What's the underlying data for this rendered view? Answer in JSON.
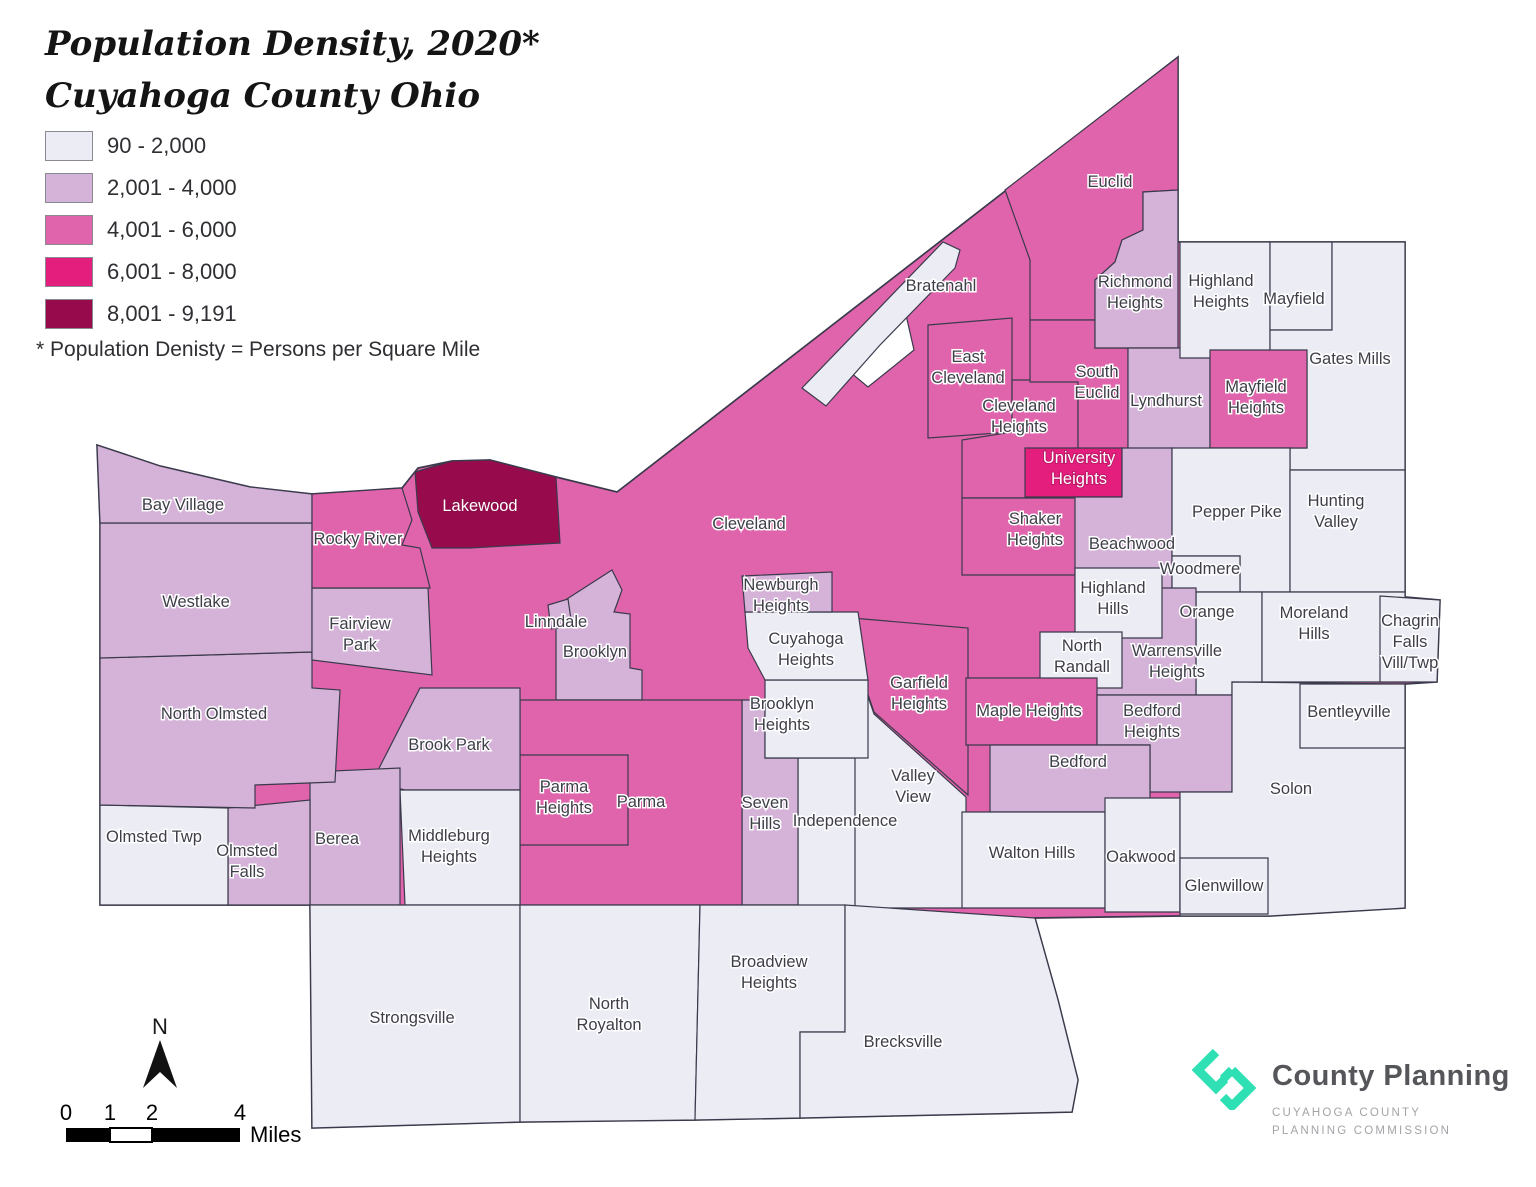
{
  "title": {
    "line1": "Population Density, 2020*",
    "line2": "Cuyahoga County Ohio"
  },
  "footnote": "* Population Denisty = Persons per Square Mile",
  "legend": {
    "items": [
      {
        "label": "90 - 2,000",
        "color": "#ececf4"
      },
      {
        "label": "2,001 - 4,000",
        "color": "#d5b2d8"
      },
      {
        "label": "4,001 - 6,000",
        "color": "#df64ab"
      },
      {
        "label": "6,001 - 8,000",
        "color": "#e41e7d"
      },
      {
        "label": "8,001 - 9,191",
        "color": "#970b4c"
      }
    ],
    "stroke": "#3a3a4c",
    "water": "#ffffff"
  },
  "scale_bar": {
    "ticks": [
      "0",
      "1",
      "2",
      "4"
    ],
    "tick_x": [
      66,
      110,
      152,
      240
    ],
    "unit": "Miles"
  },
  "north_arrow": {
    "label": "N"
  },
  "logo": {
    "name": "County Planning",
    "sub1": "CUYAHOGA COUNTY",
    "sub2": "PLANNING COMMISSION",
    "accent": "#2ee0b4"
  },
  "map": {
    "regions": [
      {
        "name": "Cleveland",
        "class": 3,
        "points": "97,445 160,466 250,487 312,494 402,488 418,468 452,461 490,460 556,477 617,492 1178,57 1178,242 1405,242 1405,597 1440,600 1437,682 1405,684 1405,908 1270,916 1180,916 1035,918 1058,1000 1078,1080 1072,1112 800,1118 695,1120 520,1122 312,1128 310,905 255,905 100,905 100,660 100,523",
        "label": {
          "x": 749,
          "y": 529,
          "lines": [
            "Cleveland"
          ]
        }
      },
      {
        "name": "Euclid",
        "class": 3,
        "points": "1005,190 1178,57 1178,190 1143,192 1143,230 1122,240 1115,262 1095,280 1095,320 1030,320 1030,260",
        "label": {
          "x": 1110,
          "y": 187,
          "lines": [
            "Euclid"
          ]
        }
      },
      {
        "name": "Lake Erie inlet",
        "class": 0,
        "points": "850,372 906,315 914,350 868,387",
        "label": null
      },
      {
        "name": "Bratenahl",
        "class": 1,
        "points": "802,388 943,242 960,250 955,268 880,345 826,406",
        "label": {
          "x": 941,
          "y": 291,
          "lines": [
            "Bratenahl"
          ]
        }
      },
      {
        "name": "East Cleveland",
        "class": 3,
        "points": "928,325 1012,318 1012,432 928,438",
        "label": {
          "x": 968,
          "y": 362,
          "lines": [
            "East",
            "Cleveland"
          ]
        }
      },
      {
        "name": "Cleveland Heights",
        "class": 3,
        "points": "1012,380 1078,380 1078,498 962,498 962,440 1012,432",
        "label": {
          "x": 1019,
          "y": 411,
          "lines": [
            "Cleveland",
            "Heights"
          ]
        }
      },
      {
        "name": "South Euclid",
        "class": 3,
        "points": "1030,320 1095,320 1095,348 1128,348 1128,450 1078,450 1078,382 1030,382",
        "label": {
          "x": 1097,
          "y": 377,
          "lines": [
            "South",
            "Euclid"
          ]
        }
      },
      {
        "name": "Richmond Heights",
        "class": 2,
        "points": "1143,192 1178,190 1178,348 1095,348 1095,280 1115,262 1122,240 1143,230",
        "label": {
          "x": 1135,
          "y": 287,
          "lines": [
            "Richmond",
            "Heights"
          ]
        }
      },
      {
        "name": "Lyndhurst",
        "class": 2,
        "points": "1128,348 1210,348 1210,450 1128,450",
        "label": {
          "x": 1166,
          "y": 406,
          "lines": [
            "Lyndhurst"
          ]
        }
      },
      {
        "name": "Highland Heights",
        "class": 1,
        "points": "1180,242 1270,242 1270,358 1180,358",
        "label": {
          "x": 1221,
          "y": 286,
          "lines": [
            "Highland",
            "Heights"
          ]
        }
      },
      {
        "name": "Mayfield",
        "class": 1,
        "points": "1270,242 1332,242 1332,330 1270,330",
        "label": {
          "x": 1294,
          "y": 304,
          "lines": [
            "Mayfield"
          ]
        }
      },
      {
        "name": "Gates Mills",
        "class": 1,
        "points": "1332,242 1405,242 1405,470 1290,470 1290,448 1307,448 1307,358 1270,358 1270,330 1332,330",
        "label": {
          "x": 1350,
          "y": 364,
          "lines": [
            "Gates Mills"
          ]
        }
      },
      {
        "name": "Mayfield Heights",
        "class": 3,
        "points": "1210,350 1307,350 1307,448 1210,448",
        "label": {
          "x": 1256,
          "y": 392,
          "lines": [
            "Mayfield",
            "Heights"
          ]
        }
      },
      {
        "name": "University Heights",
        "class": 4,
        "points": "1025,448 1122,448 1122,497 1025,497",
        "label": {
          "x": 1079,
          "y": 463,
          "lines": [
            "University",
            "Heights"
          ],
          "white": true
        }
      },
      {
        "name": "Shaker Heights",
        "class": 3,
        "points": "962,498 1120,498 1120,575 962,575",
        "label": {
          "x": 1035,
          "y": 524,
          "lines": [
            "Shaker",
            "Heights"
          ]
        }
      },
      {
        "name": "Beachwood",
        "class": 2,
        "points": "1075,497 1122,497 1122,448 1172,448 1172,592 1075,592",
        "label": {
          "x": 1132,
          "y": 549,
          "lines": [
            "Beachwood"
          ]
        }
      },
      {
        "name": "Pepper Pike",
        "class": 1,
        "points": "1172,448 1290,448 1290,592 1240,592 1240,556 1172,556",
        "label": {
          "x": 1237,
          "y": 517,
          "lines": [
            "Pepper Pike"
          ]
        }
      },
      {
        "name": "Woodmere",
        "class": 1,
        "points": "1172,556 1240,556 1240,592 1172,592",
        "label": {
          "x": 1200,
          "y": 574,
          "lines": [
            "Woodmere"
          ]
        }
      },
      {
        "name": "Hunting Valley",
        "class": 1,
        "points": "1290,470 1405,470 1405,592 1290,592",
        "label": {
          "x": 1336,
          "y": 506,
          "lines": [
            "Hunting",
            "Valley"
          ]
        }
      },
      {
        "name": "Orange",
        "class": 1,
        "points": "1196,592 1262,592 1262,682 1232,682 1232,695 1196,695",
        "label": {
          "x": 1207,
          "y": 617,
          "lines": [
            "Orange"
          ]
        }
      },
      {
        "name": "Moreland Hills",
        "class": 1,
        "points": "1262,592 1405,592 1405,682 1262,682",
        "label": {
          "x": 1314,
          "y": 618,
          "lines": [
            "Moreland",
            "Hills"
          ]
        }
      },
      {
        "name": "Chagrin Falls Vill/Twp",
        "class": 1,
        "points": "1380,596 1440,600 1437,682 1380,682",
        "label": {
          "x": 1410,
          "y": 626,
          "lines": [
            "Chagrin",
            "Falls",
            "Vill/Twp"
          ]
        }
      },
      {
        "name": "Warrensville Heights",
        "class": 2,
        "points": "1095,588 1196,588 1196,695 1095,695",
        "label": {
          "x": 1177,
          "y": 656,
          "lines": [
            "Warrensville",
            "Heights"
          ]
        }
      },
      {
        "name": "Highland Hills",
        "class": 1,
        "points": "1075,568 1162,568 1162,638 1075,638",
        "label": {
          "x": 1113,
          "y": 593,
          "lines": [
            "Highland",
            "Hills"
          ]
        }
      },
      {
        "name": "North Randall",
        "class": 1,
        "points": "1040,632 1122,632 1122,688 1040,688",
        "label": {
          "x": 1082,
          "y": 651,
          "lines": [
            "North",
            "Randall"
          ]
        }
      },
      {
        "name": "Garfield Heights",
        "class": 3,
        "points": "852,618 968,628 968,795 874,712 852,648",
        "label": {
          "x": 919,
          "y": 688,
          "lines": [
            "Garfield",
            "Heights"
          ]
        }
      },
      {
        "name": "Valley View",
        "class": 1,
        "points": "852,650 874,714 966,797 966,908 852,908",
        "label": {
          "x": 913,
          "y": 781,
          "lines": [
            "Valley",
            "View"
          ]
        }
      },
      {
        "name": "Maple Heights",
        "class": 3,
        "points": "966,678 1097,678 1097,745 966,745",
        "label": {
          "x": 1029,
          "y": 716,
          "lines": [
            "Maple Heights"
          ]
        }
      },
      {
        "name": "Bedford Heights",
        "class": 2,
        "points": "1097,695 1232,695 1232,792 1150,792 1150,745 1097,745",
        "label": {
          "x": 1152,
          "y": 716,
          "lines": [
            "Bedford",
            "Heights"
          ]
        }
      },
      {
        "name": "Bedford",
        "class": 2,
        "points": "990,745 1150,745 1150,812 990,812",
        "label": {
          "x": 1078,
          "y": 767,
          "lines": [
            "Bedford"
          ]
        }
      },
      {
        "name": "Walton Hills",
        "class": 1,
        "points": "962,812 1105,812 1105,908 962,908",
        "label": {
          "x": 1032,
          "y": 858,
          "lines": [
            "Walton Hills"
          ]
        }
      },
      {
        "name": "Oakwood",
        "class": 1,
        "points": "1105,798 1180,798 1180,912 1105,912",
        "label": {
          "x": 1141,
          "y": 862,
          "lines": [
            "Oakwood"
          ]
        }
      },
      {
        "name": "Solon",
        "class": 1,
        "points": "1232,682 1405,684 1405,908 1270,916 1180,916 1180,792 1232,792",
        "label": {
          "x": 1291,
          "y": 794,
          "lines": [
            "Solon"
          ]
        }
      },
      {
        "name": "Bentleyville",
        "class": 1,
        "points": "1300,684 1405,684 1405,748 1300,748",
        "label": {
          "x": 1349,
          "y": 717,
          "lines": [
            "Bentleyville"
          ]
        }
      },
      {
        "name": "Glenwillow",
        "class": 1,
        "points": "1180,858 1268,858 1268,914 1180,914",
        "label": {
          "x": 1224,
          "y": 891,
          "lines": [
            "Glenwillow"
          ]
        }
      },
      {
        "name": "Independence",
        "class": 1,
        "points": "798,758 855,758 855,908 798,908",
        "label": {
          "x": 845,
          "y": 826,
          "lines": [
            "Independence"
          ]
        }
      },
      {
        "name": "Seven Hills",
        "class": 2,
        "points": "742,700 765,700 765,758 798,758 798,905 742,905",
        "label": {
          "x": 765,
          "y": 808,
          "lines": [
            "Seven",
            "Hills"
          ]
        }
      },
      {
        "name": "Brooklyn Heights",
        "class": 1,
        "points": "765,680 868,680 868,758 765,758",
        "label": {
          "x": 782,
          "y": 709,
          "lines": [
            "Brooklyn",
            "Heights"
          ]
        }
      },
      {
        "name": "Cuyahoga Heights",
        "class": 1,
        "points": "745,612 858,612 868,680 765,680 748,648",
        "label": {
          "x": 806,
          "y": 644,
          "lines": [
            "Cuyahoga",
            "Heights"
          ]
        }
      },
      {
        "name": "Newburgh Heights",
        "class": 2,
        "points": "742,576 832,572 832,612 745,612",
        "label": {
          "x": 781,
          "y": 590,
          "lines": [
            "Newburgh",
            "Heights"
          ]
        }
      },
      {
        "name": "Brooklyn",
        "class": 2,
        "points": "556,606 612,570 622,590 614,612 630,614 630,668 642,670 642,700 556,700",
        "label": {
          "x": 595,
          "y": 657,
          "lines": [
            "Brooklyn"
          ]
        }
      },
      {
        "name": "Linndale",
        "class": 2,
        "points": "548,605 568,599 572,626 551,629",
        "label": {
          "x": 556,
          "y": 627,
          "lines": [
            "Linndale"
          ]
        }
      },
      {
        "name": "Parma",
        "class": 3,
        "points": "520,700 742,700 742,905 520,905",
        "label": {
          "x": 641,
          "y": 807,
          "lines": [
            "Parma"
          ]
        }
      },
      {
        "name": "Parma Heights",
        "class": 3,
        "points": "520,755 628,755 628,845 520,845",
        "label": {
          "x": 564,
          "y": 792,
          "lines": [
            "Parma",
            "Heights"
          ]
        }
      },
      {
        "name": "Brook Park",
        "class": 2,
        "points": "420,688 520,688 520,790 405,790 372,782",
        "label": {
          "x": 449,
          "y": 750,
          "lines": [
            "Brook Park"
          ]
        }
      },
      {
        "name": "Middleburg Heights",
        "class": 1,
        "points": "400,790 520,790 520,905 405,905",
        "label": {
          "x": 449,
          "y": 841,
          "lines": [
            "Middleburg",
            "Heights"
          ]
        }
      },
      {
        "name": "Berea",
        "class": 2,
        "points": "310,772 400,768 400,905 310,905",
        "label": {
          "x": 337,
          "y": 844,
          "lines": [
            "Berea"
          ]
        }
      },
      {
        "name": "Olmsted Falls",
        "class": 2,
        "points": "228,808 310,800 310,905 228,905",
        "label": {
          "x": 247,
          "y": 856,
          "lines": [
            "Olmsted",
            "Falls"
          ]
        }
      },
      {
        "name": "Olmsted Twp",
        "class": 1,
        "points": "100,805 228,808 228,905 100,905",
        "label": {
          "x": 154,
          "y": 842,
          "lines": [
            "Olmsted Twp"
          ]
        }
      },
      {
        "name": "North Olmsted",
        "class": 2,
        "points": "100,658 312,652 312,688 340,690 335,782 255,785 255,808 100,805",
        "label": {
          "x": 214,
          "y": 719,
          "lines": [
            "North Olmsted"
          ]
        }
      },
      {
        "name": "Westlake",
        "class": 2,
        "points": "100,523 312,523 312,652 100,658",
        "label": {
          "x": 196,
          "y": 607,
          "lines": [
            "Westlake"
          ]
        }
      },
      {
        "name": "Bay Village",
        "class": 2,
        "points": "97,445 160,466 250,487 312,494 312,523 100,523",
        "label": {
          "x": 183,
          "y": 510,
          "lines": [
            "Bay Village"
          ]
        }
      },
      {
        "name": "Fairview Park",
        "class": 2,
        "points": "312,588 428,588 432,675 312,660",
        "label": {
          "x": 360,
          "y": 629,
          "lines": [
            "Fairview",
            "Park"
          ]
        }
      },
      {
        "name": "Rocky River",
        "class": 3,
        "points": "312,494 402,488 412,520 402,545 420,548 430,588 312,588",
        "label": {
          "x": 358,
          "y": 544,
          "lines": [
            "Rocky River"
          ]
        }
      },
      {
        "name": "Lakewood",
        "class": 5,
        "points": "415,472 452,461 490,460 556,477 560,543 470,548 432,548 418,512",
        "label": {
          "x": 480,
          "y": 511,
          "lines": [
            "Lakewood"
          ],
          "white": true
        }
      },
      {
        "name": "Strongsville",
        "class": 1,
        "points": "310,905 520,905 520,1122 312,1128",
        "label": {
          "x": 412,
          "y": 1023,
          "lines": [
            "Strongsville"
          ]
        }
      },
      {
        "name": "North Royalton",
        "class": 1,
        "points": "520,905 700,905 695,1120 520,1122",
        "label": {
          "x": 609,
          "y": 1009,
          "lines": [
            "North",
            "Royalton"
          ]
        }
      },
      {
        "name": "Broadview Heights",
        "class": 1,
        "points": "700,905 845,905 845,1032 800,1032 800,1118 695,1120",
        "label": {
          "x": 769,
          "y": 967,
          "lines": [
            "Broadview",
            "Heights"
          ]
        }
      },
      {
        "name": "Brecksville",
        "class": 1,
        "points": "845,905 1035,918 1058,1000 1078,1080 1072,1112 800,1118 800,1032 845,1032",
        "label": {
          "x": 903,
          "y": 1047,
          "lines": [
            "Brecksville"
          ]
        }
      }
    ]
  }
}
